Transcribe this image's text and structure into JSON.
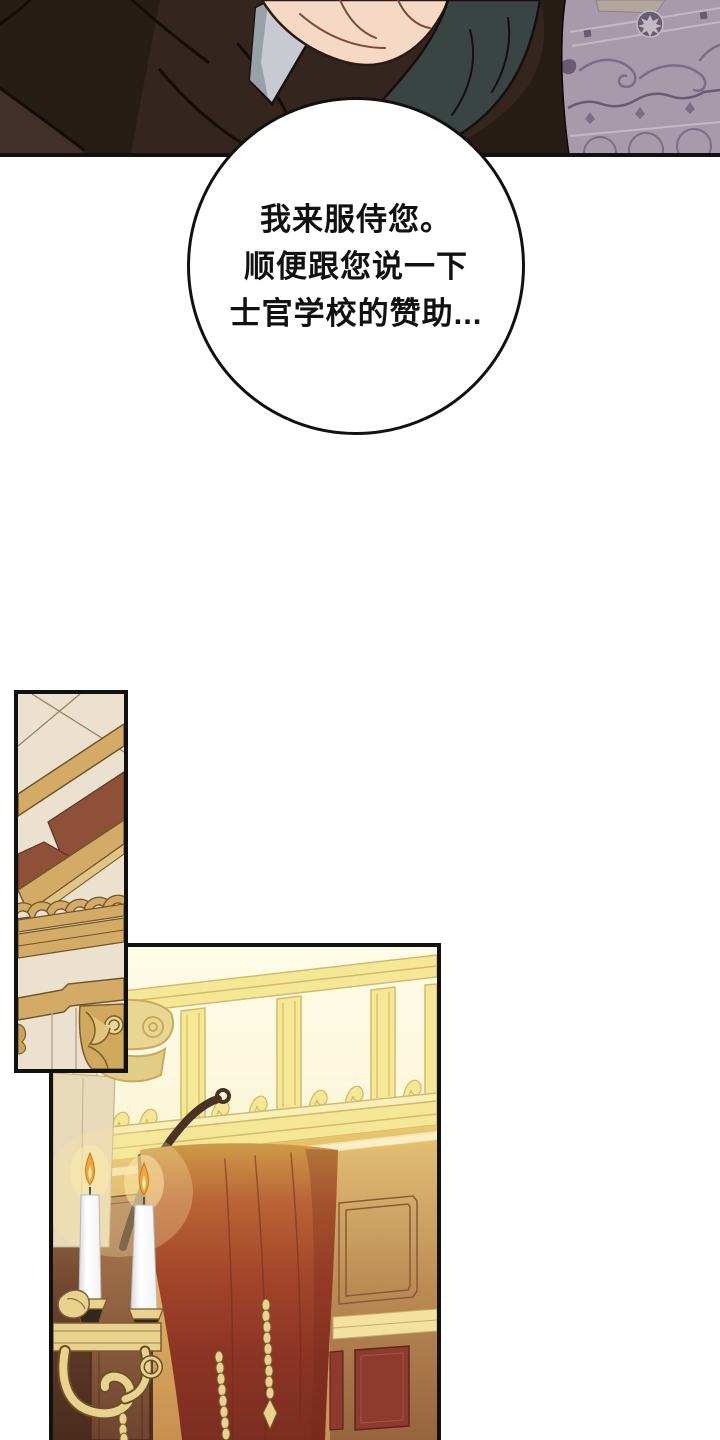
{
  "page": {
    "width": 720,
    "height": 1440,
    "background": "#ffffff"
  },
  "speech_bubble": {
    "lines": [
      "我来服侍您。",
      "顺便跟您说一下",
      "士官学校的赞助..."
    ],
    "text_color": "#111111",
    "fill": "#ffffff"
  },
  "palette": {
    "ink": "#111111",
    "paper": "#ffffff",
    "bubble_fill": "#ffffff",
    "bubble_text": "#111111",
    "coat_dark": "#281c17",
    "coat_mid": "#34261f",
    "coat_fold": "#41302a",
    "skin": "#f5d9c5",
    "skin_line": "#7a4a38",
    "cuff": "#c7cad0",
    "cuff_shadow": "#9aa0a8",
    "suit_teal": "#3a4442",
    "carpet": "#a89aab",
    "carpet_dark": "#7b6d85",
    "carpet_deep": "#685b72",
    "carpet_light": "#c3b8c6",
    "carpet_tile": "#b3a79c",
    "cream": "#ece1cf",
    "beam_tan": "#d4ab66",
    "beam_edge": "#6f5428",
    "beam_light": "#e3c488",
    "coffer_red": "#8e5138",
    "gold_capital": "#e9d691",
    "rail_gold": "#f4e896",
    "rail_line": "#d5ba6a",
    "curtain_red": "#a2452a",
    "curtain_deep": "#7a2b20",
    "candle": "#fefefe",
    "flame": "#f0a83c",
    "flame_glow": "#fce9a8",
    "metal_gold": "#e9d28d",
    "metal_dark": "#7a5c32",
    "cup_dark": "#33261a",
    "wood_dark": "#6e4630"
  }
}
